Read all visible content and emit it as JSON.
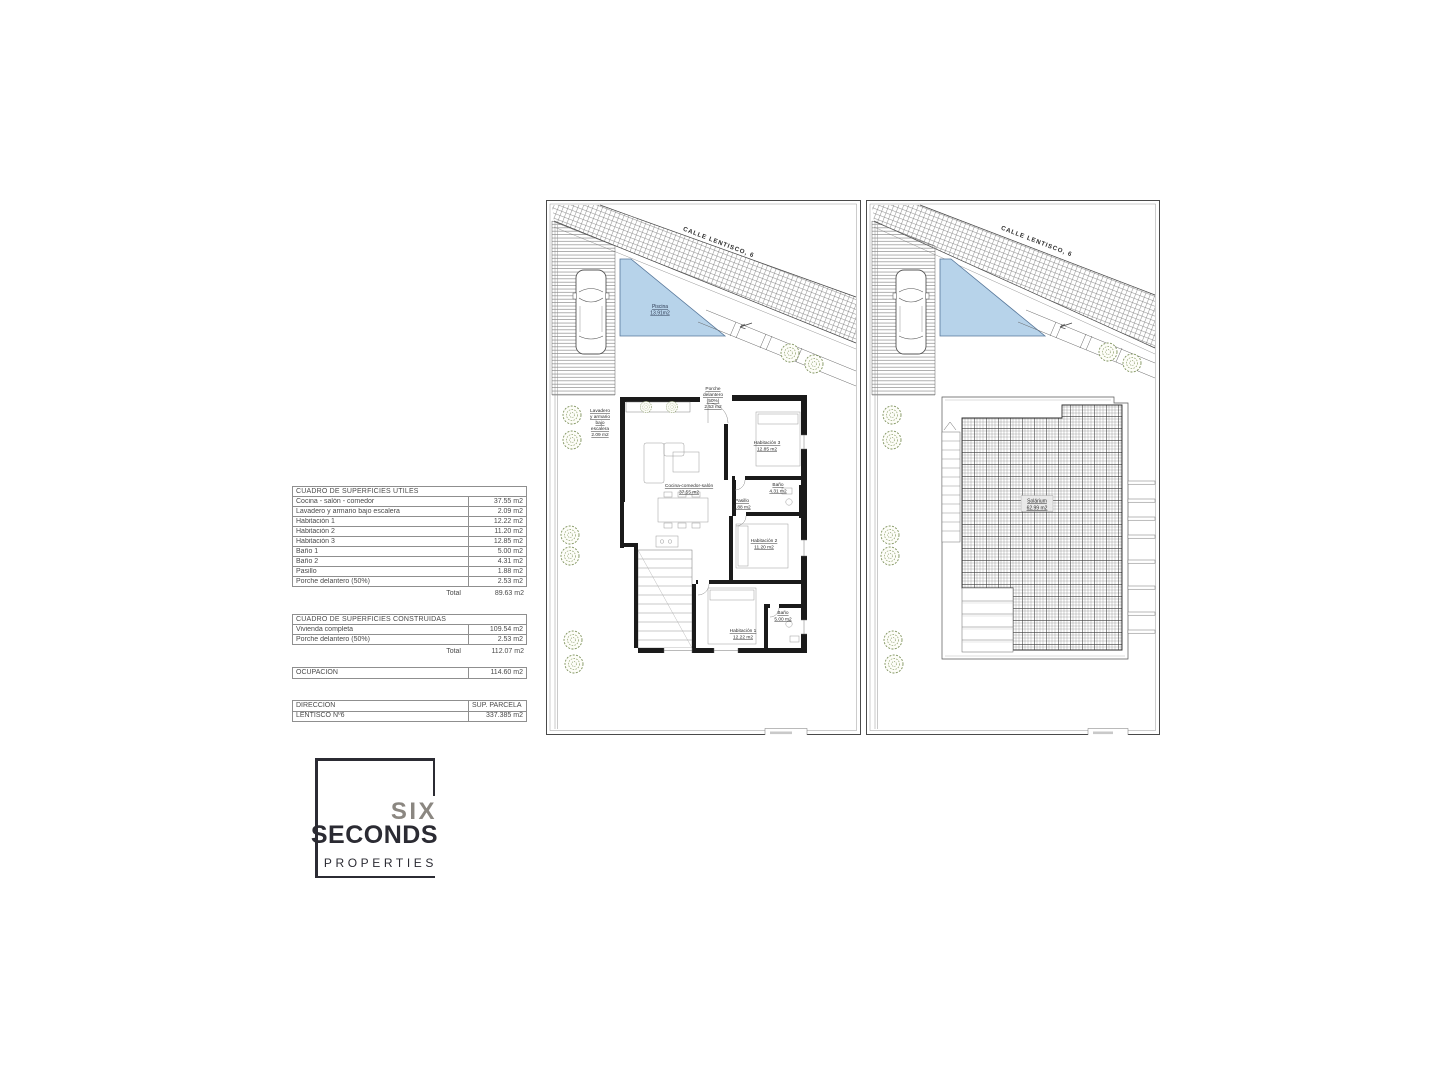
{
  "plans": {
    "street_label": "CALLE LENTISCO, 6",
    "ground": {
      "pool": [
        "Piscina",
        "13.91m2"
      ],
      "porche": [
        "Porche",
        "delantero",
        "(50%)",
        "2.53 m2"
      ],
      "lavadero": [
        "Lavadero",
        "y armario",
        "bajo",
        "escalera",
        "2.09 m2"
      ],
      "hab3": [
        "Habitación 3",
        "12.85 m2"
      ],
      "cocina": [
        "Cocina-comedor-salón",
        "37.55 m2"
      ],
      "bano2": [
        "Baño",
        "4.31 m2"
      ],
      "pasillo": [
        "Pasillo",
        "1.88 m2"
      ],
      "hab2": [
        "Habitación 2",
        "11.20 m2"
      ],
      "bano1": [
        "Baño",
        "5.00 m2"
      ],
      "hab1": [
        "Habitación 1",
        "12.22 m2"
      ]
    },
    "roof": {
      "solarium": [
        "Solárium",
        "62.99 m2"
      ]
    }
  },
  "tables": {
    "utiles": {
      "title": "CUADRO DE SUPERFICIES ÚTILES",
      "rows": [
        {
          "label": "Cocina - salón - comedor",
          "value": "37.55 m2"
        },
        {
          "label": "Lavadero y armario bajo escalera",
          "value": "2.09 m2"
        },
        {
          "label": "Habitación 1",
          "value": "12.22 m2"
        },
        {
          "label": "Habitación 2",
          "value": "11.20 m2"
        },
        {
          "label": "Habitación 3",
          "value": "12.85 m2"
        },
        {
          "label": "Baño 1",
          "value": "5.00 m2"
        },
        {
          "label": "Baño 2",
          "value": "4.31 m2"
        },
        {
          "label": "Pasillo",
          "value": "1.88 m2"
        },
        {
          "label": "Porche delantero (50%)",
          "value": "2.53 m2"
        }
      ],
      "total_label": "Total",
      "total_value": "89.63 m2"
    },
    "construidas": {
      "title": "CUADRO DE SUPERFICIES CONSTRUIDAS",
      "rows": [
        {
          "label": "Vivienda completa",
          "value": "109.54 m2"
        },
        {
          "label": "Porche delantero (50%)",
          "value": "2.53 m2"
        }
      ],
      "total_label": "Total",
      "total_value": "112.07 m2"
    },
    "ocupacion": {
      "label": "OCUPACIÓN",
      "value": "114.60 m2"
    },
    "direccion": {
      "header_label": "DIRECCIÓN",
      "header_value": "SUP. PARCELA",
      "row_label": "LENTISCO Nº6",
      "row_value": "337.385 m2"
    }
  },
  "logo": {
    "line1": "SIX",
    "line2": "SECONDS",
    "line3": "PROPERTIES"
  },
  "colors": {
    "pool_fill": "#b7d3ea",
    "wall_black": "#1a1a1a",
    "logo_dark": "#2b2b33",
    "logo_gray": "#8b8781",
    "tree_green": "#7f935d"
  }
}
